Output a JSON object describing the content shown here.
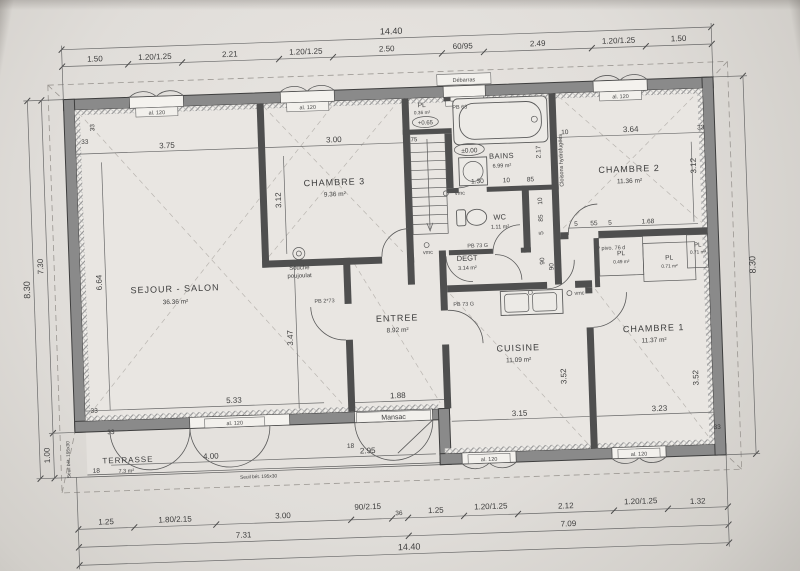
{
  "plan": {
    "totals": {
      "width": "14.40",
      "height_right": "8.30",
      "height_left": "8.30",
      "height_upper": "7.30",
      "height_lower": "1.00",
      "bottom_left_sub": "7.31",
      "bottom_right_sub": "7.09",
      "width_bottom": "14.40"
    },
    "top_chain": [
      "1.50",
      "1.20/1.25",
      "2.21",
      "1.20/1.25",
      "2.50",
      "60/95",
      "2.49",
      "1.20/1.25",
      "1.50"
    ],
    "bottom_chain": [
      "1.25",
      "1.80/2.15",
      "3.00",
      "90/2.15",
      "36",
      "1.25",
      "1.20/1.25",
      "2.12",
      "1.20/1.25",
      "1.32"
    ],
    "rooms": {
      "sejour": {
        "name": "SEJOUR - SALON",
        "area": "36.36 m²",
        "d_top": "3.75",
        "d_left": "6.64",
        "d_bottom": "5.33",
        "d_right": "3.47"
      },
      "ch3": {
        "name": "CHAMBRE 3",
        "area": "9.36 m²",
        "d_top": "3.00",
        "d_left": "3.12"
      },
      "bains": {
        "name": "BAINS",
        "area": "6.99 m²",
        "level": "±0.00",
        "d_right": "2.17",
        "b1": "1.30",
        "b2": "10",
        "b3": "85"
      },
      "wc": {
        "name": "WC",
        "area": "1.11 m²",
        "r1": "10",
        "r2": "85",
        "r3": "5",
        "r4": "90"
      },
      "ch2": {
        "name": "CHAMBRE 2",
        "area": "11.36 m²",
        "d_top": "3.64",
        "d_top2": "10",
        "d_right": "3.12",
        "b1": "5",
        "b2": "55",
        "b3": "5",
        "b4": "1.68"
      },
      "degt": {
        "name": "DEGT",
        "area": "3.14 m²"
      },
      "entree": {
        "name": "ENTREE",
        "area": "8.92 m²",
        "d_bottom": "1.88"
      },
      "cuisine": {
        "name": "CUISINE",
        "area": "11.09 m²",
        "d_bottom": "3.15",
        "d_right": "3.52",
        "d_corr": "90"
      },
      "ch1": {
        "name": "CHAMBRE 1",
        "area": "11.37 m²",
        "d_bottom": "3.23",
        "d_right": "3.52"
      },
      "terrasse": {
        "name": "TERRASSE",
        "area": "7.3 m²",
        "d1": "4.00",
        "d2": "2.95",
        "d3": "18",
        "d4": "18"
      },
      "pl_top": {
        "name": "PL",
        "area": "0.36 m²",
        "level": "+0.65",
        "w": "75"
      },
      "pl1": {
        "name": "PL",
        "area": "0.49 m²"
      },
      "pl2": {
        "name": "PL",
        "area": "0.71 m²"
      },
      "pl3": {
        "name": "PL",
        "area": "0.71 m²"
      }
    },
    "small_dims": {
      "d33": "33"
    },
    "annotations": {
      "souche_l1": "Souche",
      "souche_l2": "poujoulat",
      "mansac": "Mansac",
      "debarras": "Débarras",
      "cloisons": "Cloisons hydrofugées",
      "vmc": "vmc",
      "seuil": "Seuil bét. 195x30"
    },
    "door_tags": {
      "pb63": "PB 63",
      "pb273": "PB 2*73",
      "pb73g": "PB 73 G",
      "ppivo": "P pivo. 76 d"
    },
    "window_tags": {
      "large": "al. 120",
      "small": "al. 60"
    }
  }
}
